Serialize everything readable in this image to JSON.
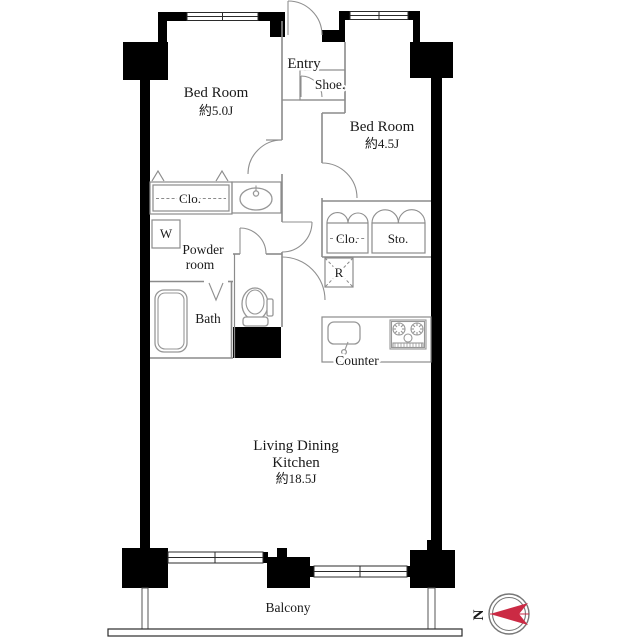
{
  "floorplan": {
    "rooms": {
      "bedroom_5": {
        "name": "Bed Room",
        "area": "約5.0J"
      },
      "bedroom_45": {
        "name": "Bed Room",
        "area": "約4.5J"
      },
      "living_dining_kitchen": {
        "name_line1": "Living Dining",
        "name_line2": "Kitchen",
        "area": "約18.5J"
      },
      "entry": {
        "name": "Entry"
      },
      "powder_room": {
        "name_line1": "Powder",
        "name_line2": "room"
      },
      "bath": {
        "name": "Bath"
      },
      "balcony": {
        "name": "Balcony"
      }
    },
    "fixtures": {
      "shoe_cabinet": "Shoe.",
      "closet_bedroom5": "Clo.",
      "closet_bedroom45": "Clo.",
      "storage": "Sto.",
      "washing_machine": "W",
      "refrigerator": "R",
      "kitchen_counter": "Counter"
    },
    "compass": {
      "north_label": "N"
    },
    "colors": {
      "walls": "#000000",
      "thin_lines": "#8b8b8b",
      "text": "#1a1a1a",
      "compass_red": "#cb2a44",
      "background": "#ffffff"
    }
  }
}
